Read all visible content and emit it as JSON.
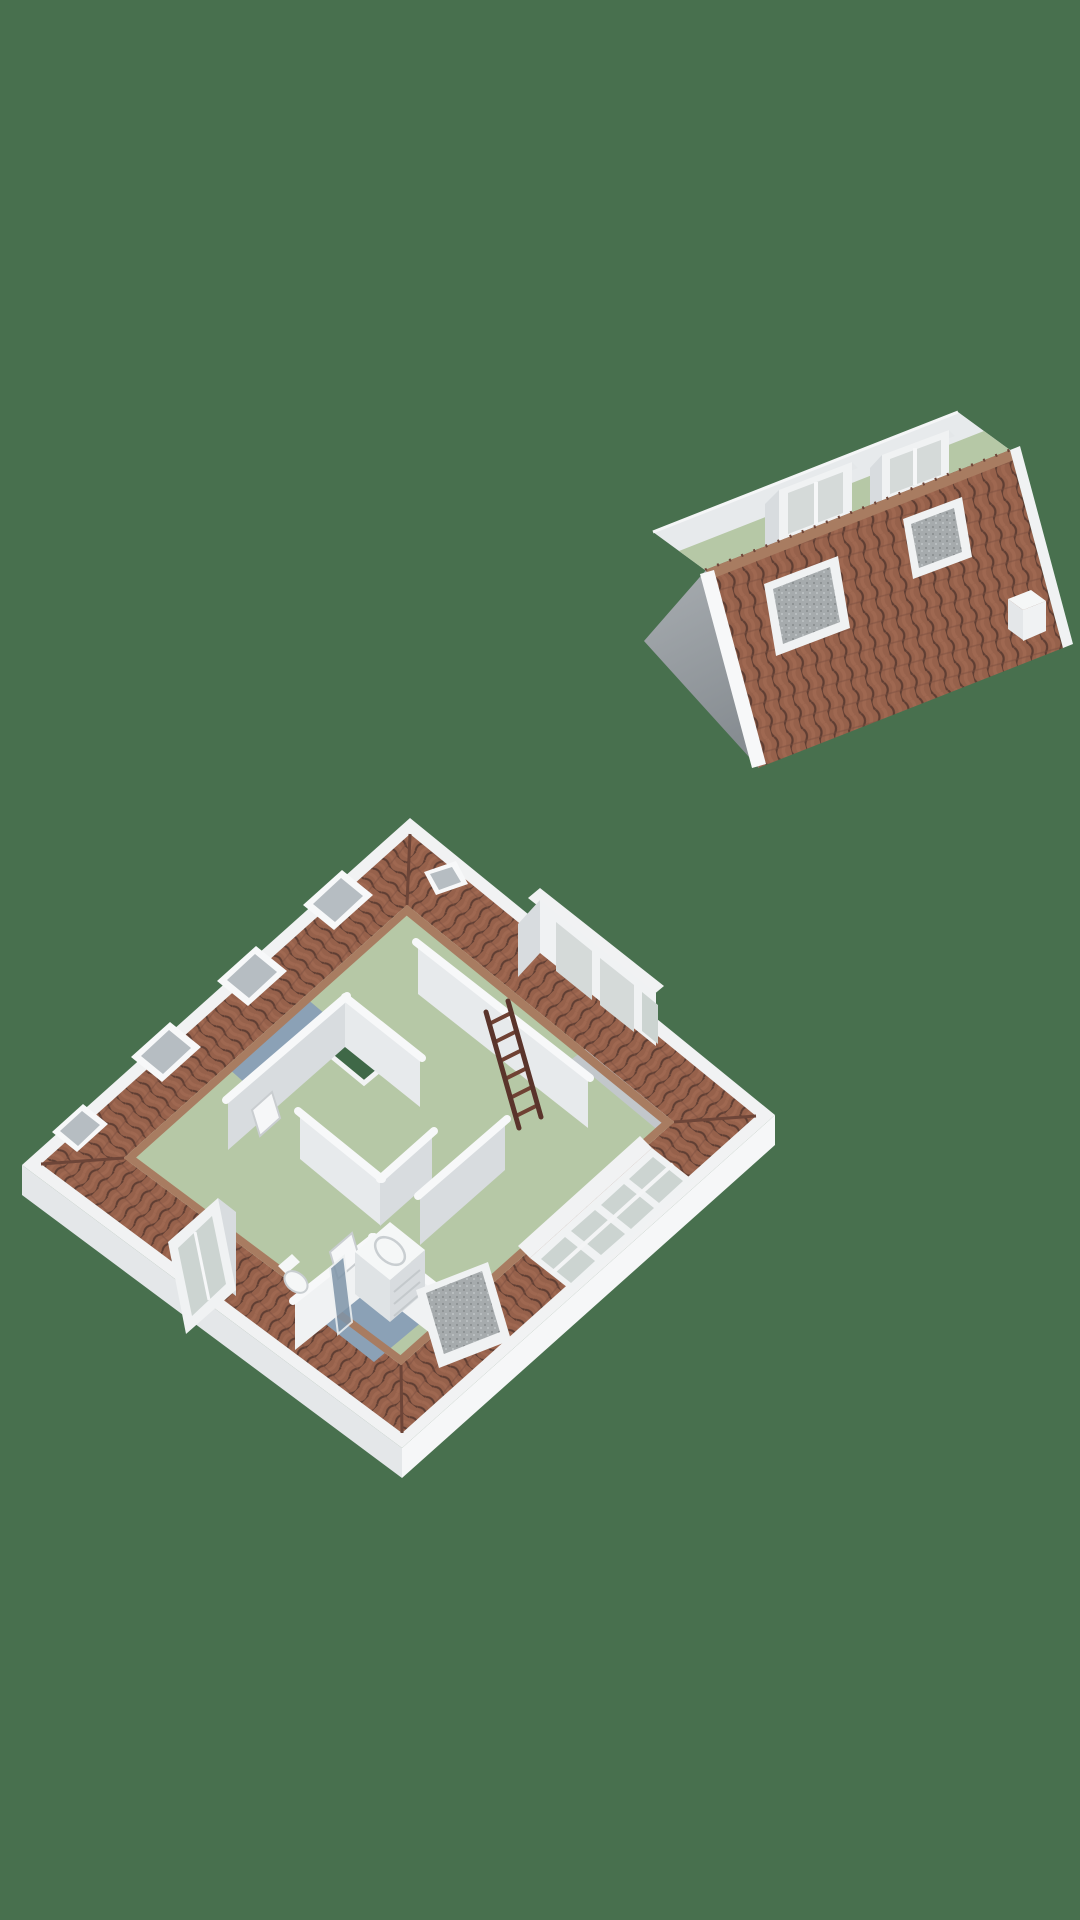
{
  "canvas": {
    "width": 1080,
    "height": 1920,
    "view": "3d-dollhouse-floorplan-render",
    "background": "#48704e"
  },
  "colors": {
    "background": "#48704e",
    "stair_void": "#3f6847",
    "floor_green": "#b6c8a6",
    "floor_blue": "#8ba1b6",
    "tile_base": "#96614b",
    "tile_groove": "#5f3e33",
    "tile_highlight": "#ab7258",
    "tile_row": "#7a4e3f",
    "ridge_cap": "#a87c61",
    "hip_seam": "#6d4538",
    "slab_top": "#f1f2f3",
    "slab_side_light": "#f6f7f8",
    "slab_side_shade": "#e4e7e9",
    "wall_cap": "#f7f8f9",
    "wall_face_bright": "#f0f2f3",
    "wall_face_light": "#e7eaec",
    "wall_face_mid": "#d8dcdf",
    "wall_face_gray": "#c2c7cb",
    "gable_light": "#a8adb1",
    "gable_dark": "#878d92",
    "glass_light": "#d5dad9",
    "glass_gray": "#b6bdc2",
    "glass_green": "#ccd4d1",
    "sash_mesh": "#a6abad",
    "sash_dot": "#8b9092",
    "sash_dot_light": "#c0c4c6",
    "ladder_rail": "#5a342b",
    "ladder_rung": "#6f4133",
    "fixture_white": "#f5f7f7",
    "fixture_shade": "#dfe3e5",
    "shower_glass": "#7f95a9"
  },
  "scene": {
    "sections": [
      {
        "id": "roof-section",
        "label": "detached roof cap",
        "features": [
          "tiled-slope",
          "ridge-caps",
          "gable-end-wall",
          "attic-floor-strip",
          "dormer",
          "dormer",
          "open-skylight-sash",
          "open-skylight-sash",
          "chimney"
        ]
      },
      {
        "id": "attic-floor-plan",
        "label": "attic storey cutaway",
        "rooms": [
          {
            "id": "bedroom-top",
            "floor": "green"
          },
          {
            "id": "bedroom-left",
            "floor": "green"
          },
          {
            "id": "bedroom-right",
            "floor": "green"
          },
          {
            "id": "landing",
            "floor": "blue"
          },
          {
            "id": "bathroom",
            "floor": "blue",
            "fixtures": [
              "toilet",
              "sink-vanity",
              "shower-screen"
            ]
          }
        ],
        "objects": [
          "loft-ladder",
          "stairwell-opening",
          "roof-window",
          "roof-window",
          "roof-window",
          "roof-window",
          "roof-window",
          "ne-dormer-windows",
          "sw-dormer-window",
          "se-window-row",
          "open-skylight-sash"
        ]
      }
    ]
  }
}
